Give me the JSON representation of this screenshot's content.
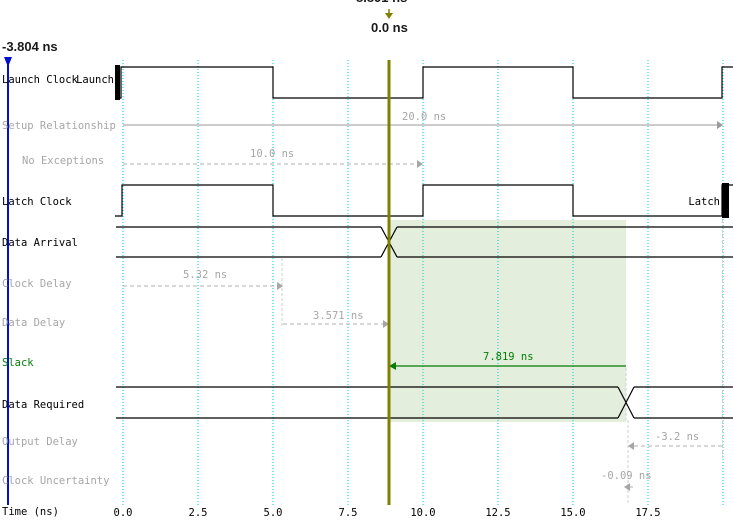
{
  "markers": {
    "top_clipped": "8.891 ns",
    "cursor": "0.0 ns",
    "left": "-3.804 ns"
  },
  "rows": {
    "launch_clock": "Launch Clock",
    "setup_relationship": "Setup Relationship",
    "no_exceptions": "No Exceptions",
    "latch_clock": "Latch Clock",
    "data_arrival": "Data Arrival",
    "clock_delay": "Clock Delay",
    "data_delay": "Data Delay",
    "slack": "Slack",
    "data_required": "Data Required",
    "output_delay": "Output Delay",
    "clock_uncertainty": "Clock Uncertainty"
  },
  "annotations": {
    "setup": "20.0 ns",
    "no_exceptions": "10.0 ns",
    "clock_delay": "5.32 ns",
    "data_delay": "3.571 ns",
    "slack": "7.819 ns",
    "output_delay": "-3.2 ns",
    "clock_uncertainty": "-0.09 ns"
  },
  "edges": {
    "launch": "Launch",
    "latch": "Latch"
  },
  "axis": {
    "label": "Time (ns)",
    "ticks": [
      "0.0",
      "2.5",
      "5.0",
      "7.5",
      "10.0",
      "12.5",
      "15.0",
      "17.5"
    ]
  },
  "colors": {
    "cursor_olive": "#808000",
    "marker_blue": "#0010cc",
    "gridline_cyan": "#00cfcf",
    "slack_green": "#067d06",
    "slack_region_fill": "#e4eedd",
    "dim_gray": "#a6a6a6",
    "waveform_black": "#000000"
  }
}
